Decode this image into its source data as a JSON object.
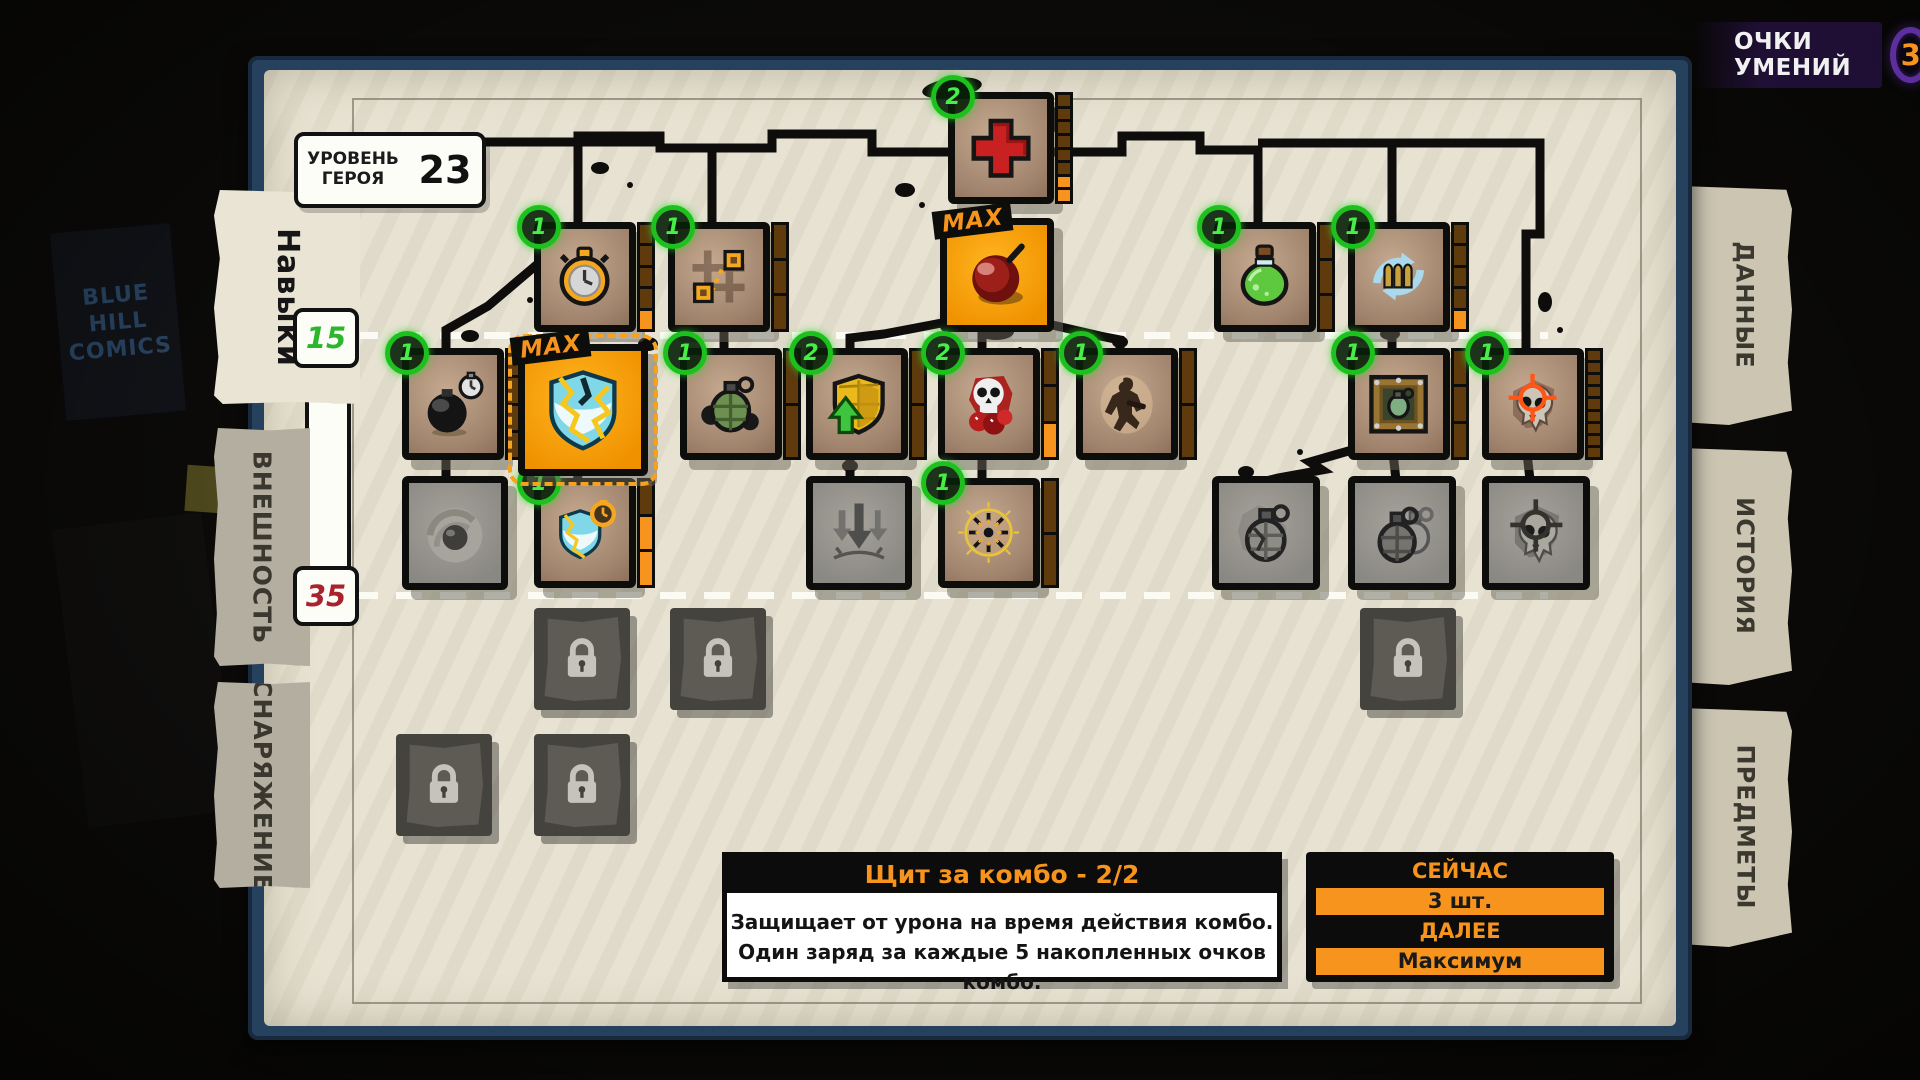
{
  "colors": {
    "accent_orange": "#F7941D",
    "badge_green": "#2FD12F",
    "frame_blue": "#26415E",
    "paper": "#E7E2D2",
    "marker_15": "#2DB52D",
    "marker_35": "#A8232D",
    "points_ring": "#5D2F9E"
  },
  "background": {
    "poster_line1": "BLUE",
    "poster_line2": "HILL",
    "poster_line3": "COMICS"
  },
  "header": {
    "skill_points_label": "ОЧКИ УМЕНИЙ",
    "skill_points_value": "3"
  },
  "hero_level": {
    "label_line1": "УРОВЕНЬ",
    "label_line2": "ГЕРОЯ",
    "value": "23"
  },
  "left_tabs": [
    {
      "id": "skills",
      "label": "Навыки",
      "active": true
    },
    {
      "id": "appearance",
      "label": "ВНЕШНОСТЬ",
      "active": false
    },
    {
      "id": "equipment",
      "label": "СНАРЯЖЕНИЕ",
      "active": false
    }
  ],
  "right_tabs": [
    {
      "id": "data",
      "label": "ДАННЫЕ"
    },
    {
      "id": "history",
      "label": "ИСТОРИЯ"
    },
    {
      "id": "items",
      "label": "ПРЕДМЕТЫ"
    }
  ],
  "level_markers": [
    {
      "value": "15",
      "color": "#2DB52D"
    },
    {
      "value": "35",
      "color": "#A8232D"
    }
  ],
  "skill_nodes": [
    {
      "id": "health",
      "icon": "health-cross",
      "x": 948,
      "y": 92,
      "w": 92,
      "h": 98,
      "state": "active",
      "badge": "2",
      "bar": {
        "segments": 8,
        "filled": 2
      }
    },
    {
      "id": "stopwatch",
      "icon": "stopwatch",
      "x": 534,
      "y": 222,
      "w": 88,
      "h": 96,
      "state": "active",
      "badge": "1",
      "bar": {
        "segments": 5,
        "filled": 1
      }
    },
    {
      "id": "teleport",
      "icon": "teleport",
      "x": 668,
      "y": 222,
      "w": 88,
      "h": 96,
      "state": "active",
      "badge": "1",
      "bar": {
        "segments": 3,
        "filled": 0
      }
    },
    {
      "id": "mega-bomb",
      "icon": "bomb",
      "x": 940,
      "y": 218,
      "w": 100,
      "h": 100,
      "state": "max",
      "max_label": "MAX"
    },
    {
      "id": "potion",
      "icon": "potion",
      "x": 1214,
      "y": 222,
      "w": 88,
      "h": 96,
      "state": "active",
      "badge": "1",
      "bar": {
        "segments": 3,
        "filled": 0
      }
    },
    {
      "id": "reload",
      "icon": "reload",
      "x": 1348,
      "y": 222,
      "w": 88,
      "h": 96,
      "state": "active",
      "badge": "1",
      "bar": {
        "segments": 5,
        "filled": 1
      }
    },
    {
      "id": "timed-bomb",
      "icon": "bomb-timer",
      "x": 402,
      "y": 348,
      "w": 88,
      "h": 98,
      "state": "active",
      "badge": "1",
      "bar": {
        "segments": 4,
        "filled": 0
      }
    },
    {
      "id": "combo-shield",
      "icon": "combo-shield",
      "x": 518,
      "y": 344,
      "w": 116,
      "h": 118,
      "state": "max",
      "max_label": "MAX",
      "selected": true
    },
    {
      "id": "grenade",
      "icon": "grenade-green",
      "x": 680,
      "y": 348,
      "w": 88,
      "h": 98,
      "state": "active",
      "badge": "1",
      "bar": {
        "segments": 2,
        "filled": 0
      }
    },
    {
      "id": "shield-upgrade",
      "icon": "shield-arrow",
      "x": 806,
      "y": 348,
      "w": 88,
      "h": 98,
      "state": "active",
      "badge": "2",
      "bar": {
        "segments": 2,
        "filled": 0
      }
    },
    {
      "id": "skull-bombs",
      "icon": "skull-bombs",
      "x": 938,
      "y": 348,
      "w": 88,
      "h": 98,
      "state": "active",
      "badge": "2",
      "bar": {
        "segments": 3,
        "filled": 1
      }
    },
    {
      "id": "berserk",
      "icon": "soldier",
      "x": 1076,
      "y": 348,
      "w": 88,
      "h": 98,
      "state": "active",
      "badge": "1",
      "bar": {
        "segments": 2,
        "filled": 0
      }
    },
    {
      "id": "crate-grenade",
      "icon": "crate-grenade",
      "x": 1348,
      "y": 348,
      "w": 88,
      "h": 98,
      "state": "active",
      "badge": "1",
      "bar": {
        "segments": 3,
        "filled": 0
      }
    },
    {
      "id": "skull-crosshair",
      "icon": "skull-crosshair",
      "x": 1482,
      "y": 348,
      "w": 88,
      "h": 98,
      "state": "active",
      "badge": "1",
      "bar": {
        "segments": 9,
        "filled": 0
      }
    },
    {
      "id": "vortex",
      "icon": "vortex",
      "x": 402,
      "y": 476,
      "w": 92,
      "h": 100,
      "state": "inactive"
    },
    {
      "id": "shield-timer",
      "icon": "shield-timer",
      "x": 534,
      "y": 478,
      "w": 88,
      "h": 96,
      "state": "active",
      "badge": "1",
      "bar": {
        "segments": 3,
        "filled": 2
      }
    },
    {
      "id": "airstrike",
      "icon": "airstrike",
      "x": 806,
      "y": 476,
      "w": 92,
      "h": 100,
      "state": "inactive"
    },
    {
      "id": "combo-ring",
      "icon": "radial-burst",
      "x": 938,
      "y": 478,
      "w": 88,
      "h": 96,
      "state": "active",
      "badge": "1",
      "bar": {
        "segments": 2,
        "filled": 0
      }
    },
    {
      "id": "cracked-grenade",
      "icon": "grenade-cracked",
      "x": 1212,
      "y": 476,
      "w": 94,
      "h": 100,
      "state": "inactive"
    },
    {
      "id": "double-grenade",
      "icon": "grenade-double",
      "x": 1348,
      "y": 476,
      "w": 94,
      "h": 100,
      "state": "inactive"
    },
    {
      "id": "skull-crosshair-2",
      "icon": "skull-crosshair-grey",
      "x": 1482,
      "y": 476,
      "w": 94,
      "h": 100,
      "state": "inactive"
    },
    {
      "id": "locked-1",
      "icon": "lock",
      "x": 534,
      "y": 608,
      "w": 96,
      "h": 102,
      "state": "locked"
    },
    {
      "id": "locked-2",
      "icon": "lock",
      "x": 670,
      "y": 608,
      "w": 96,
      "h": 102,
      "state": "locked"
    },
    {
      "id": "locked-3",
      "icon": "lock",
      "x": 1360,
      "y": 608,
      "w": 96,
      "h": 102,
      "state": "locked"
    },
    {
      "id": "locked-4",
      "icon": "lock",
      "x": 396,
      "y": 734,
      "w": 96,
      "h": 102,
      "state": "locked"
    },
    {
      "id": "locked-5",
      "icon": "lock",
      "x": 534,
      "y": 734,
      "w": 96,
      "h": 102,
      "state": "locked"
    }
  ],
  "tooltip": {
    "title": "Щит за комбо - 2/2",
    "body_line1": "Защищает от урона на время действия комбо.",
    "body_line2": "Один заряд за каждые 5 накопленных очков комбо."
  },
  "upgrade_panel": {
    "current_label": "СЕЙЧАС",
    "current_value": "3 шт.",
    "next_label": "ДАЛЕЕ",
    "next_value": "Максимум"
  }
}
